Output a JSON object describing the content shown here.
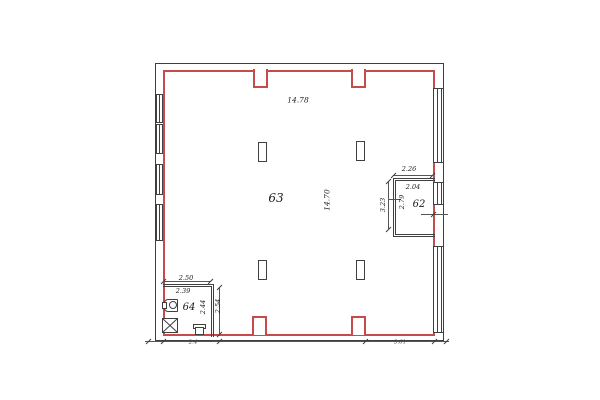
{
  "drawing": {
    "kind": "architectural floor plan",
    "colors": {
      "wall_accent_red": "#c84b4b",
      "line": "#3f3f3f",
      "text": "#1a1a1a",
      "background": "#ffffff"
    }
  },
  "rooms": [
    {
      "number": "63",
      "width_label": "14.78",
      "height_label": "14.70"
    },
    {
      "number": "62",
      "dims": {
        "top_outer": "2.26",
        "top_inner": "2.04",
        "left": "2.79",
        "pier": "3.23"
      }
    },
    {
      "number": "64",
      "dims": {
        "top_outer": "2.50",
        "top_inner": "2.39",
        "right_inner": "2.44",
        "right_outer": "2.54"
      }
    }
  ],
  "bottom_dimension_chain": {
    "left": "2.4",
    "middle": "· · ·",
    "right": "3.61"
  },
  "symbols": [
    {
      "name": "wash-basin",
      "room": "64"
    },
    {
      "name": "ventilation-shaft",
      "room": "64"
    },
    {
      "name": "toilet",
      "room": "64"
    },
    {
      "name": "structural-column",
      "count": 4
    },
    {
      "name": "window",
      "walls": [
        "left",
        "right"
      ]
    }
  ]
}
